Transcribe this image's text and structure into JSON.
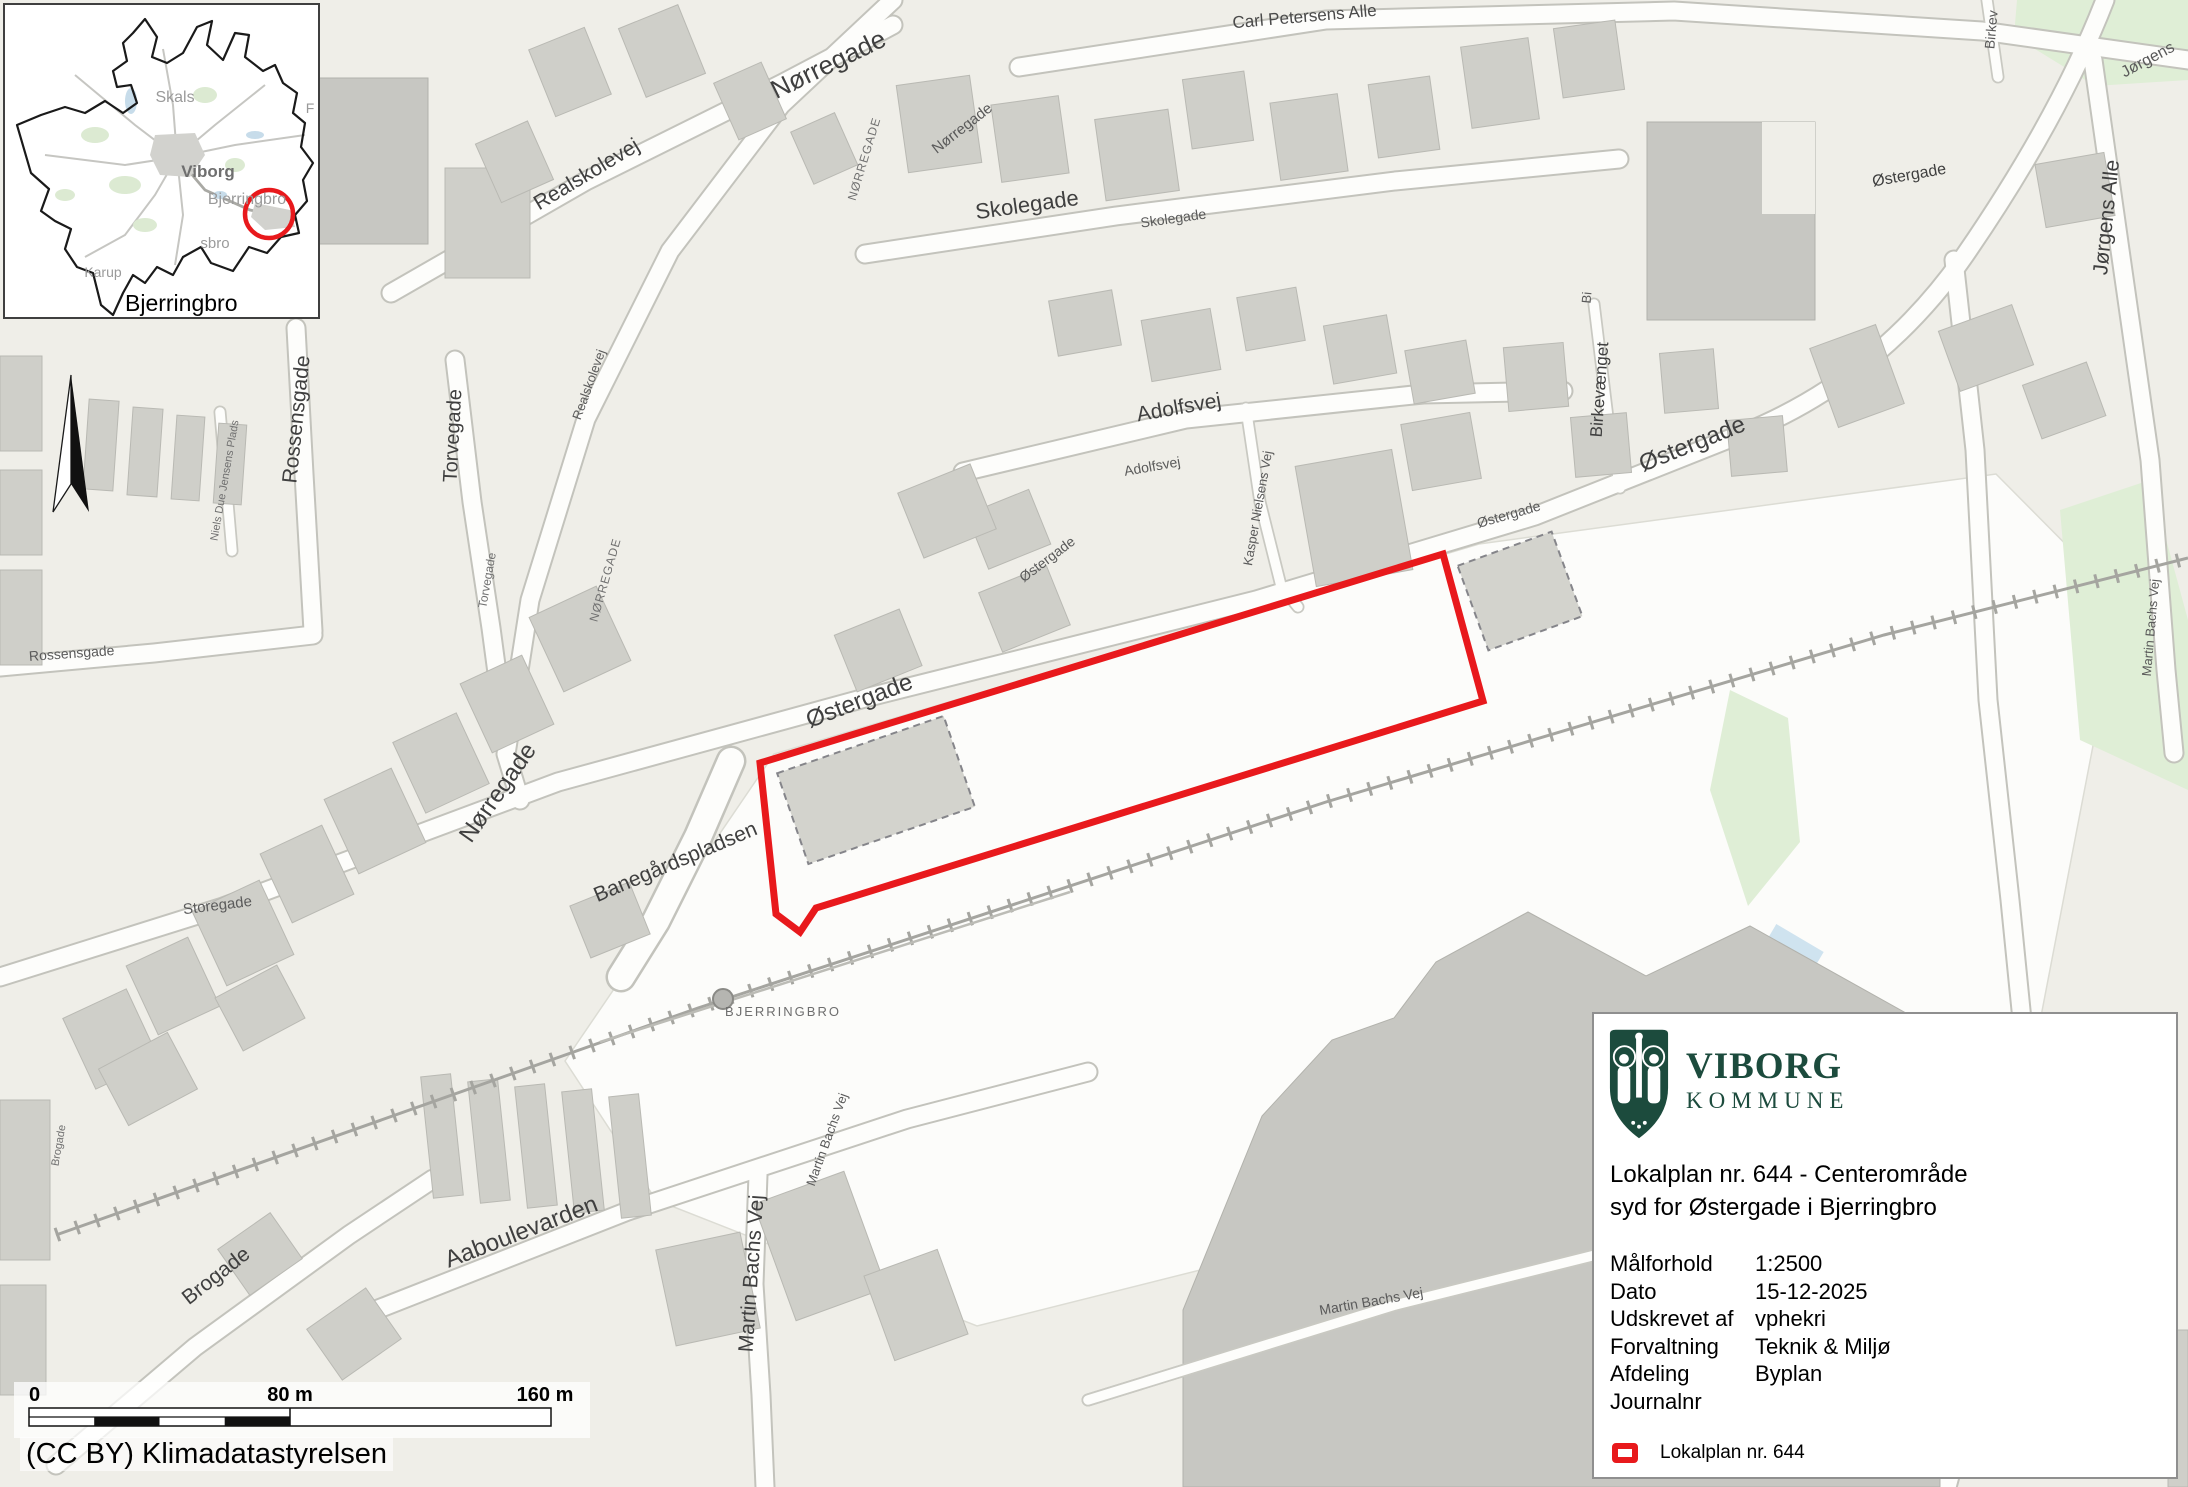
{
  "colors": {
    "lokalplan_red": "#e8191c",
    "brand_green": "#1c4b3d",
    "building_gray": "#cfcfc9",
    "water_blue": "#cfe3ef",
    "green_area": "#dfeed6"
  },
  "inset": {
    "labels": {
      "skals": "Skals",
      "viborg": "Viborg",
      "bjerringbro": "Bjerringbro",
      "karup": "Karup",
      "sbro_fragment": "sbro",
      "f_fragment": "F"
    },
    "caption": "Bjerringbro"
  },
  "scalebar": {
    "start": "0",
    "mid": "80 m",
    "end": "160 m"
  },
  "attribution": "(CC BY) Klimadatastyrelsen",
  "panel": {
    "brand": {
      "name": "VIBORG",
      "subtitle": "KOMMUNE"
    },
    "title_line1": "Lokalplan nr. 644 - Centerområde",
    "title_line2": "syd for Østergade i Bjerringbro",
    "details": [
      {
        "label": "Målforhold",
        "value": "1:2500"
      },
      {
        "label": "Dato",
        "value": "15-12-2025"
      },
      {
        "label": "Udskrevet af",
        "value": "vphekri"
      },
      {
        "label": "Forvaltning",
        "value": "Teknik & Miljø"
      },
      {
        "label": "Afdeling",
        "value": "Byplan"
      },
      {
        "label": "Journalnr",
        "value": ""
      }
    ],
    "legend_label": "Lokalplan nr. 644"
  },
  "map": {
    "station_label": "BJERRINGBRO",
    "street_labels": [
      {
        "t": "Carl Petersens Alle",
        "x": 1305,
        "y": 22,
        "r": -5,
        "s": 17,
        "c": "#4a4a4a"
      },
      {
        "t": "Nørregade",
        "x": 832,
        "y": 72,
        "r": -26,
        "s": 26,
        "c": "#3f3f3f"
      },
      {
        "t": "Nørregade",
        "x": 965,
        "y": 132,
        "r": -38,
        "s": 15,
        "c": "#5a5a5a"
      },
      {
        "t": "NØRREGADE",
        "x": 868,
        "y": 160,
        "r": -73,
        "s": 12,
        "c": "#707070",
        "ls": 1
      },
      {
        "t": "Realskolevej",
        "x": 590,
        "y": 180,
        "r": -31,
        "s": 21,
        "c": "#3f3f3f"
      },
      {
        "t": "Skolegade",
        "x": 1028,
        "y": 212,
        "r": -8,
        "s": 22,
        "c": "#3f3f3f"
      },
      {
        "t": "Skolegade",
        "x": 1174,
        "y": 223,
        "r": -8,
        "s": 14,
        "c": "#5a5a5a"
      },
      {
        "t": "Østergade",
        "x": 1910,
        "y": 180,
        "r": -10,
        "s": 16,
        "c": "#3f3f3f"
      },
      {
        "t": "Jørgens",
        "x": 2150,
        "y": 64,
        "r": -28,
        "s": 16,
        "c": "#5a5a5a"
      },
      {
        "t": "Jørgens Alle",
        "x": 2113,
        "y": 218,
        "r": -84,
        "s": 21,
        "c": "#3f3f3f"
      },
      {
        "t": "Birkev",
        "x": 1996,
        "y": 30,
        "r": -85,
        "s": 14,
        "c": "#5a5a5a"
      },
      {
        "t": "Rossensgade",
        "x": 303,
        "y": 420,
        "r": -84,
        "s": 21,
        "c": "#3f3f3f"
      },
      {
        "t": "Rossensgade",
        "x": 72,
        "y": 658,
        "r": -4,
        "s": 14,
        "c": "#5a5a5a"
      },
      {
        "t": "Torvegade",
        "x": 459,
        "y": 436,
        "r": -87,
        "s": 20,
        "c": "#3f3f3f"
      },
      {
        "t": "Torvegade",
        "x": 491,
        "y": 581,
        "r": -80,
        "s": 12,
        "c": "#707070"
      },
      {
        "t": "Realskolevej",
        "x": 593,
        "y": 386,
        "r": -70,
        "s": 13,
        "c": "#5a5a5a"
      },
      {
        "t": "NØRREGADE",
        "x": 609,
        "y": 581,
        "r": -74,
        "s": 12,
        "c": "#707070",
        "ls": 1
      },
      {
        "t": "Adolfsvej",
        "x": 1180,
        "y": 414,
        "r": -10,
        "s": 21,
        "c": "#3f3f3f"
      },
      {
        "t": "Adolfsvej",
        "x": 1153,
        "y": 471,
        "r": -10,
        "s": 14,
        "c": "#5a5a5a"
      },
      {
        "t": "Kasper Nielsens Vej",
        "x": 1262,
        "y": 509,
        "r": -80,
        "s": 13,
        "c": "#5a5a5a"
      },
      {
        "t": "Bi",
        "x": 1591,
        "y": 298,
        "r": -85,
        "s": 13,
        "c": "#5a5a5a"
      },
      {
        "t": "Birkevænget",
        "x": 1605,
        "y": 390,
        "r": -86,
        "s": 17,
        "c": "#3f3f3f"
      },
      {
        "t": "Østergade",
        "x": 1695,
        "y": 451,
        "r": -22,
        "s": 24,
        "c": "#3f3f3f"
      },
      {
        "t": "Østergade",
        "x": 1510,
        "y": 519,
        "r": -16,
        "s": 14,
        "c": "#5a5a5a"
      },
      {
        "t": "Østergade",
        "x": 1050,
        "y": 563,
        "r": -37,
        "s": 14,
        "c": "#5a5a5a"
      },
      {
        "t": "Martin Bachs Vej",
        "x": 2155,
        "y": 628,
        "r": -85,
        "s": 13,
        "c": "#5a5a5a"
      },
      {
        "t": "Østergade",
        "x": 862,
        "y": 708,
        "r": -21,
        "s": 24,
        "c": "#3f3f3f"
      },
      {
        "t": "Nørregade",
        "x": 504,
        "y": 797,
        "r": -55,
        "s": 24,
        "c": "#3f3f3f"
      },
      {
        "t": "Banegårdspladsen",
        "x": 678,
        "y": 868,
        "r": -23,
        "s": 21,
        "c": "#3f3f3f"
      },
      {
        "t": "Storegade",
        "x": 218,
        "y": 910,
        "r": -7,
        "s": 15,
        "c": "#5a5a5a"
      },
      {
        "t": "Niels Due Jensens Plads",
        "x": 228,
        "y": 481,
        "r": -80,
        "s": 11,
        "c": "#707070"
      },
      {
        "t": "BJERRINGBRO",
        "x": 783,
        "y": 1016,
        "r": 0,
        "s": 13,
        "c": "#6e6e6e",
        "ls": 2
      },
      {
        "t": "Aaboulevarden",
        "x": 524,
        "y": 1239,
        "r": -21,
        "s": 24,
        "c": "#3f3f3f"
      },
      {
        "t": "Martin Bachs Vej",
        "x": 758,
        "y": 1274,
        "r": -86,
        "s": 21,
        "c": "#3f3f3f"
      },
      {
        "t": "Martin Bachs Vej",
        "x": 831,
        "y": 1141,
        "r": -70,
        "s": 13,
        "c": "#5a5a5a"
      },
      {
        "t": "Martin Bachs Vej",
        "x": 1372,
        "y": 1306,
        "r": -10,
        "s": 14,
        "c": "#5a5a5a"
      },
      {
        "t": "Brogade",
        "x": 220,
        "y": 1281,
        "r": -38,
        "s": 21,
        "c": "#3f3f3f"
      },
      {
        "t": "Brogade",
        "x": 62,
        "y": 1146,
        "r": -80,
        "s": 11,
        "c": "#707070"
      }
    ]
  }
}
